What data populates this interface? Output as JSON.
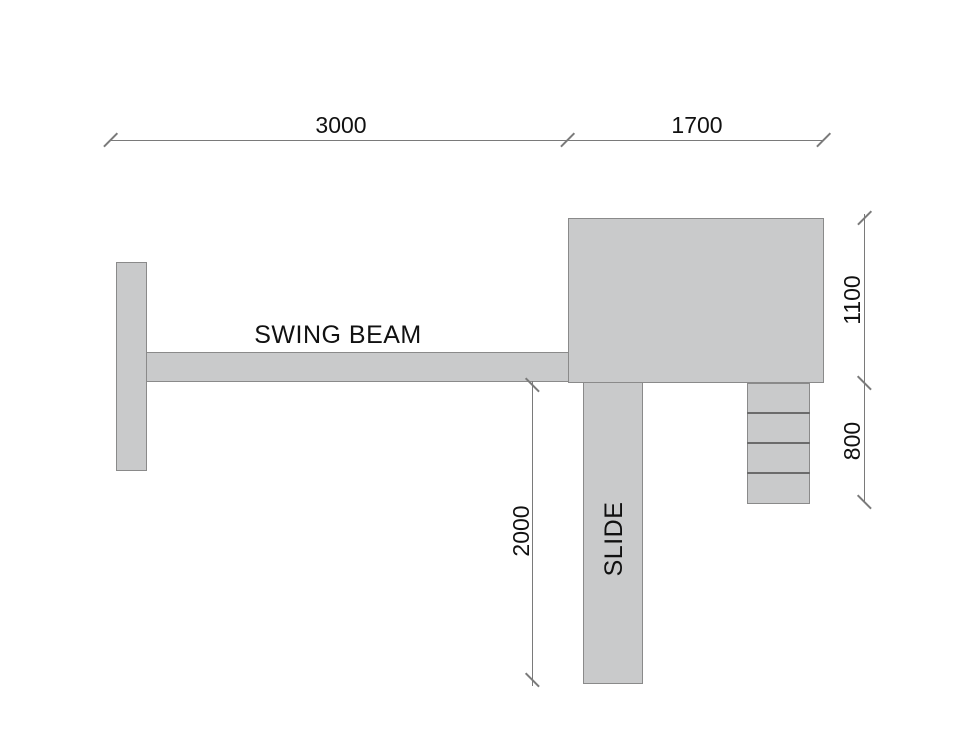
{
  "drawing": {
    "labels": {
      "swing_beam": "SWING BEAM",
      "slide": "SLIDE"
    },
    "dimensions": {
      "swing_span": "3000",
      "platform_span": "1700",
      "platform_height": "1100",
      "ladder_height": "800",
      "slide_height": "2000"
    },
    "ladder_steps": 4,
    "colors": {
      "fill": "#C9CACB",
      "outline": "#8A8A8A",
      "ladder_line": "#6B6B6B",
      "dim_line": "#7A7A7A",
      "text": "#111111",
      "background": "#FFFFFF"
    }
  }
}
